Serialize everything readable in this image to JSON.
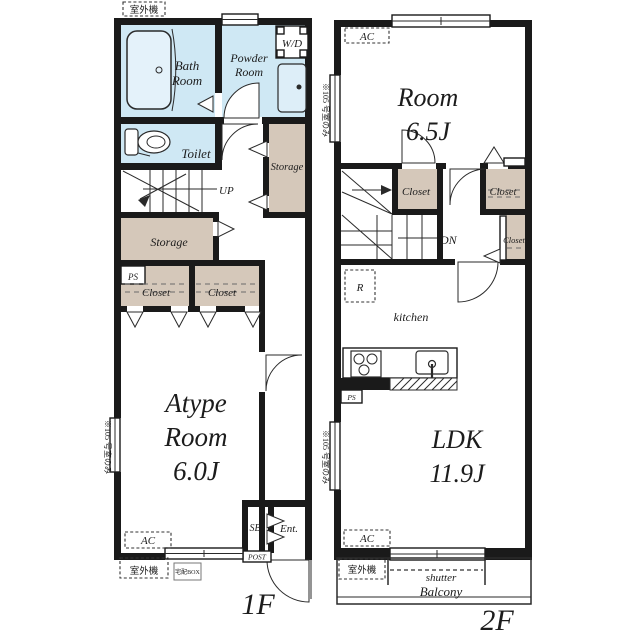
{
  "colors": {
    "wall": "#1a1a1a",
    "wet_room_fill": "#cfe8f4",
    "storage_fill": "#d5c8ba",
    "background": "#ffffff"
  },
  "floor1": {
    "title": "1F",
    "outdoor_unit_top": "室外機",
    "bath_line1": "Bath",
    "bath_line2": "Room",
    "powder_line1": "Powder",
    "powder_line2": "Room",
    "wd": "W/D",
    "toilet": "Toilet",
    "storage_right": "Storage",
    "up": "UP",
    "storage_mid": "Storage",
    "ps": "PS",
    "closet_left": "Closet",
    "closet_right": "Closet",
    "room_line1": "Atype",
    "room_line2": "Room",
    "room_line3": "6.0J",
    "ac": "AC",
    "outdoor_unit_bottom": "室外機",
    "delivery_box": "宅配BOX",
    "post": "POST",
    "sb": "SB",
    "entrance": "Ent.",
    "side_note": "※105 号室のみ"
  },
  "floor2": {
    "title": "2F",
    "ac_top": "AC",
    "room_line1": "Room",
    "room_line2": "6.5J",
    "closet_a": "Closet",
    "closet_b": "Closet",
    "closet_c": "Closet",
    "dn": "DN",
    "refrigerator": "R",
    "kitchen": "kitchen",
    "ps": "PS",
    "ldk_line1": "LDK",
    "ldk_line2": "11.9J",
    "ac_bottom": "AC",
    "outdoor_unit": "室外機",
    "shutter": "shutter",
    "balcony": "Balcony",
    "side_note_top": "※105 号室のみ",
    "side_note_bottom": "※105 号室のみ"
  }
}
